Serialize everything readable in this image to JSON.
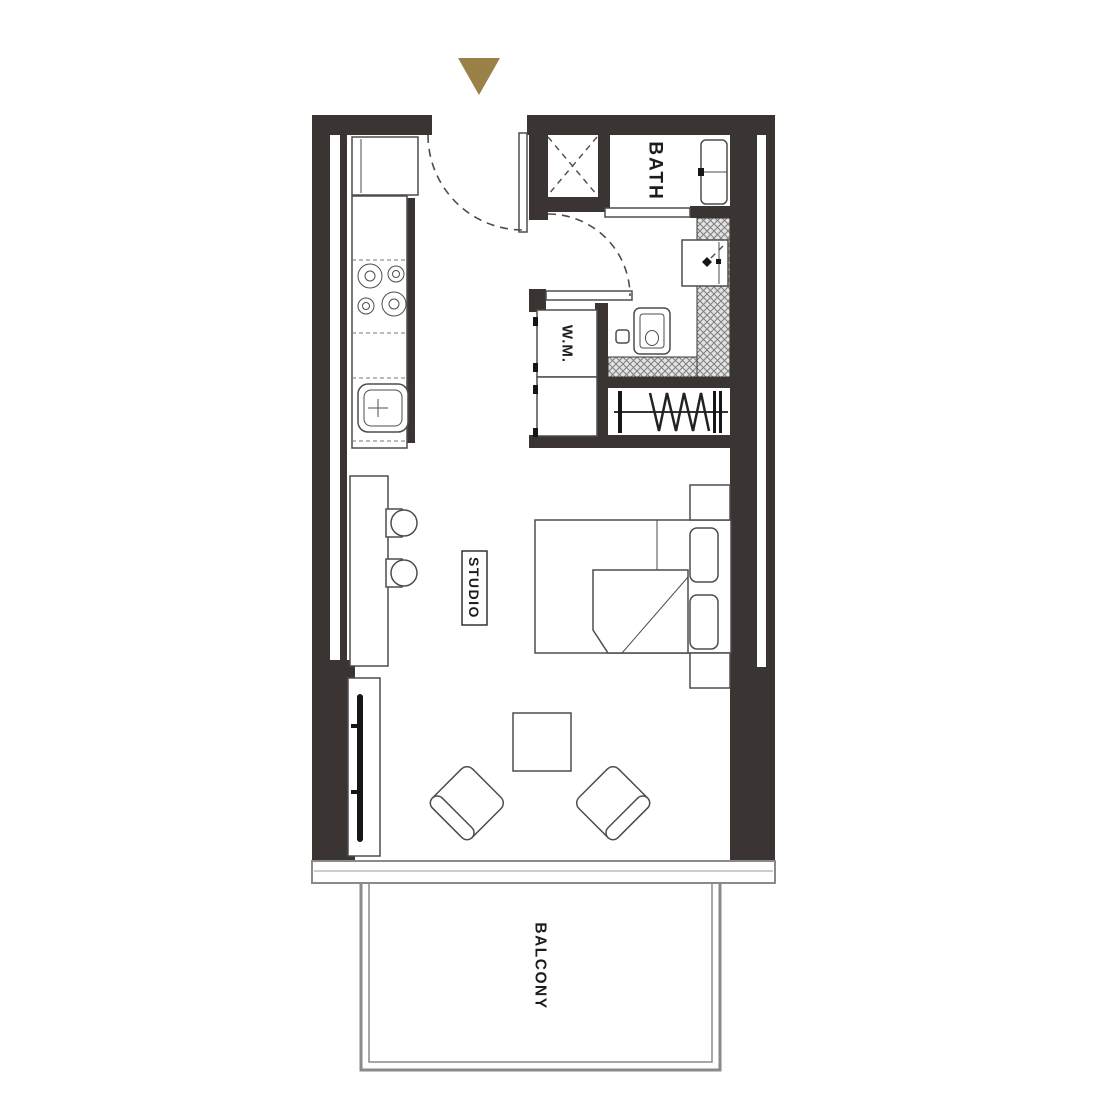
{
  "title": "Studio apartment floor plan",
  "colors": {
    "wall": "#3a3533",
    "accent": "#9a8148",
    "line": "#4d4d4d",
    "text": "#1c1c1c",
    "hatch_line": "#7e7e7e",
    "hatch_bg": "#e3e3e3",
    "rail": "#8a8a8a"
  },
  "labels": {
    "studio": "STUDIO",
    "bath": "BATH",
    "washing_machine": "W.M.",
    "balcony": "BALCONY"
  },
  "icons": {
    "entrance_marker": "triangle-down"
  }
}
